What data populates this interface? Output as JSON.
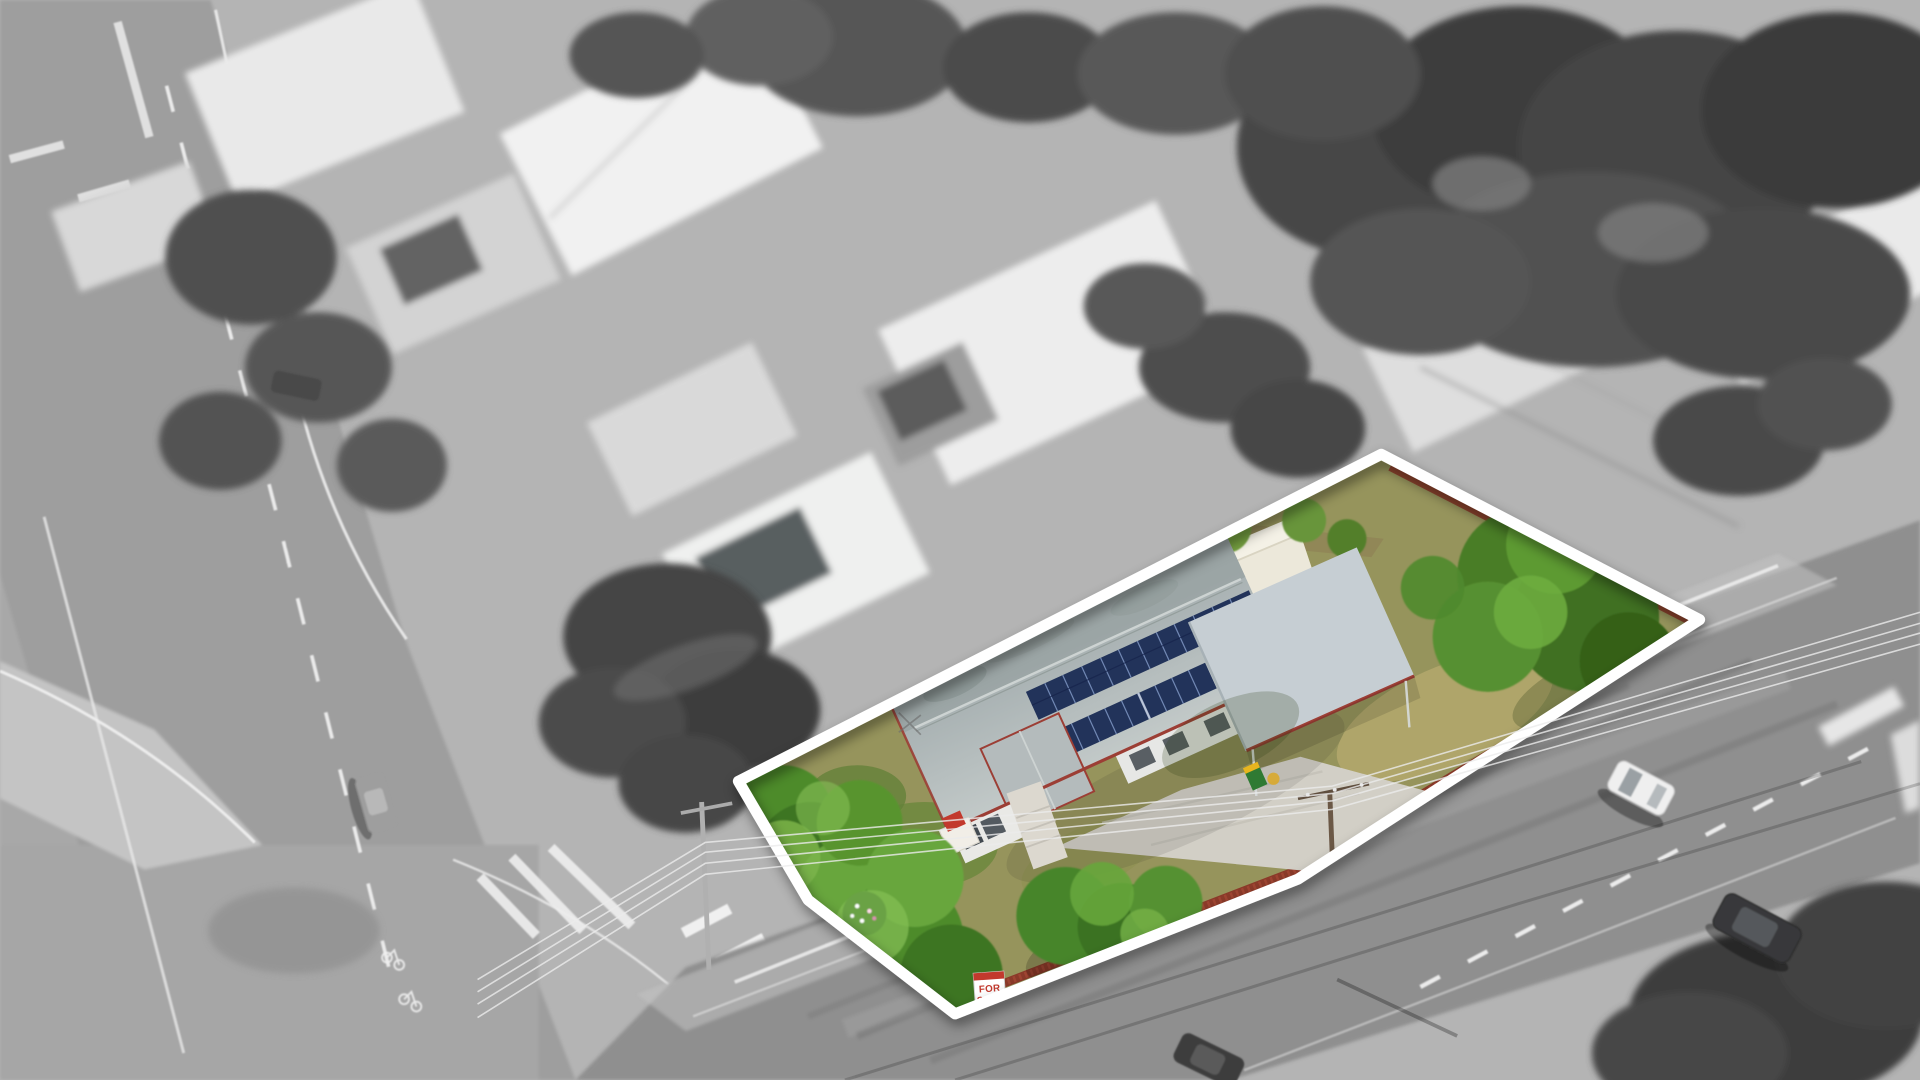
{
  "scene": {
    "kind": "aerial drone photograph of a suburban property",
    "treatment": "surroundings desaturated to black and white, featured lot in full colour inside a thick white boundary outline",
    "background_color": "#b4b4b4",
    "road_color": "#8f8f8f"
  },
  "property": {
    "outline_color": "#ffffff",
    "fence_color": "#8b3a29",
    "lawn_color": "#96945c",
    "tree_color": "#4e8b2c",
    "roof_color": "#aab3b4",
    "carport_color": "#c6ced3",
    "trim_color": "#9c3e35",
    "solar_color": "#22335a",
    "shed_color": "#ece8da",
    "concrete_color": "#d2cfc6",
    "bin_body_color": "#2f7a33",
    "bin_lid_color": "#e8b51f",
    "objects": [
      "house with solar panels",
      "carport",
      "garden shed",
      "timber paling fence",
      "lawn",
      "dense front-yard trees",
      "wheelie bin",
      "concrete driveway",
      "for-sale sign",
      "power pole and wires"
    ]
  },
  "sign": {
    "line1": "FOR",
    "line2": "SALE",
    "text_color": "#c2392d",
    "panel_color": "#ffffff",
    "header_color": "#c2392d"
  },
  "surroundings": {
    "vehicles": [
      "white hatchback on side street",
      "dark SUV on side street",
      "grey car on main road",
      "dark parked car near main road",
      "dark car at bottom edge"
    ],
    "features": [
      "main road with lane markings and bike symbols",
      "side street",
      "painted traffic island",
      "suburban rooftops",
      "dense tropical tree canopy",
      "power lines crossing frame"
    ]
  }
}
